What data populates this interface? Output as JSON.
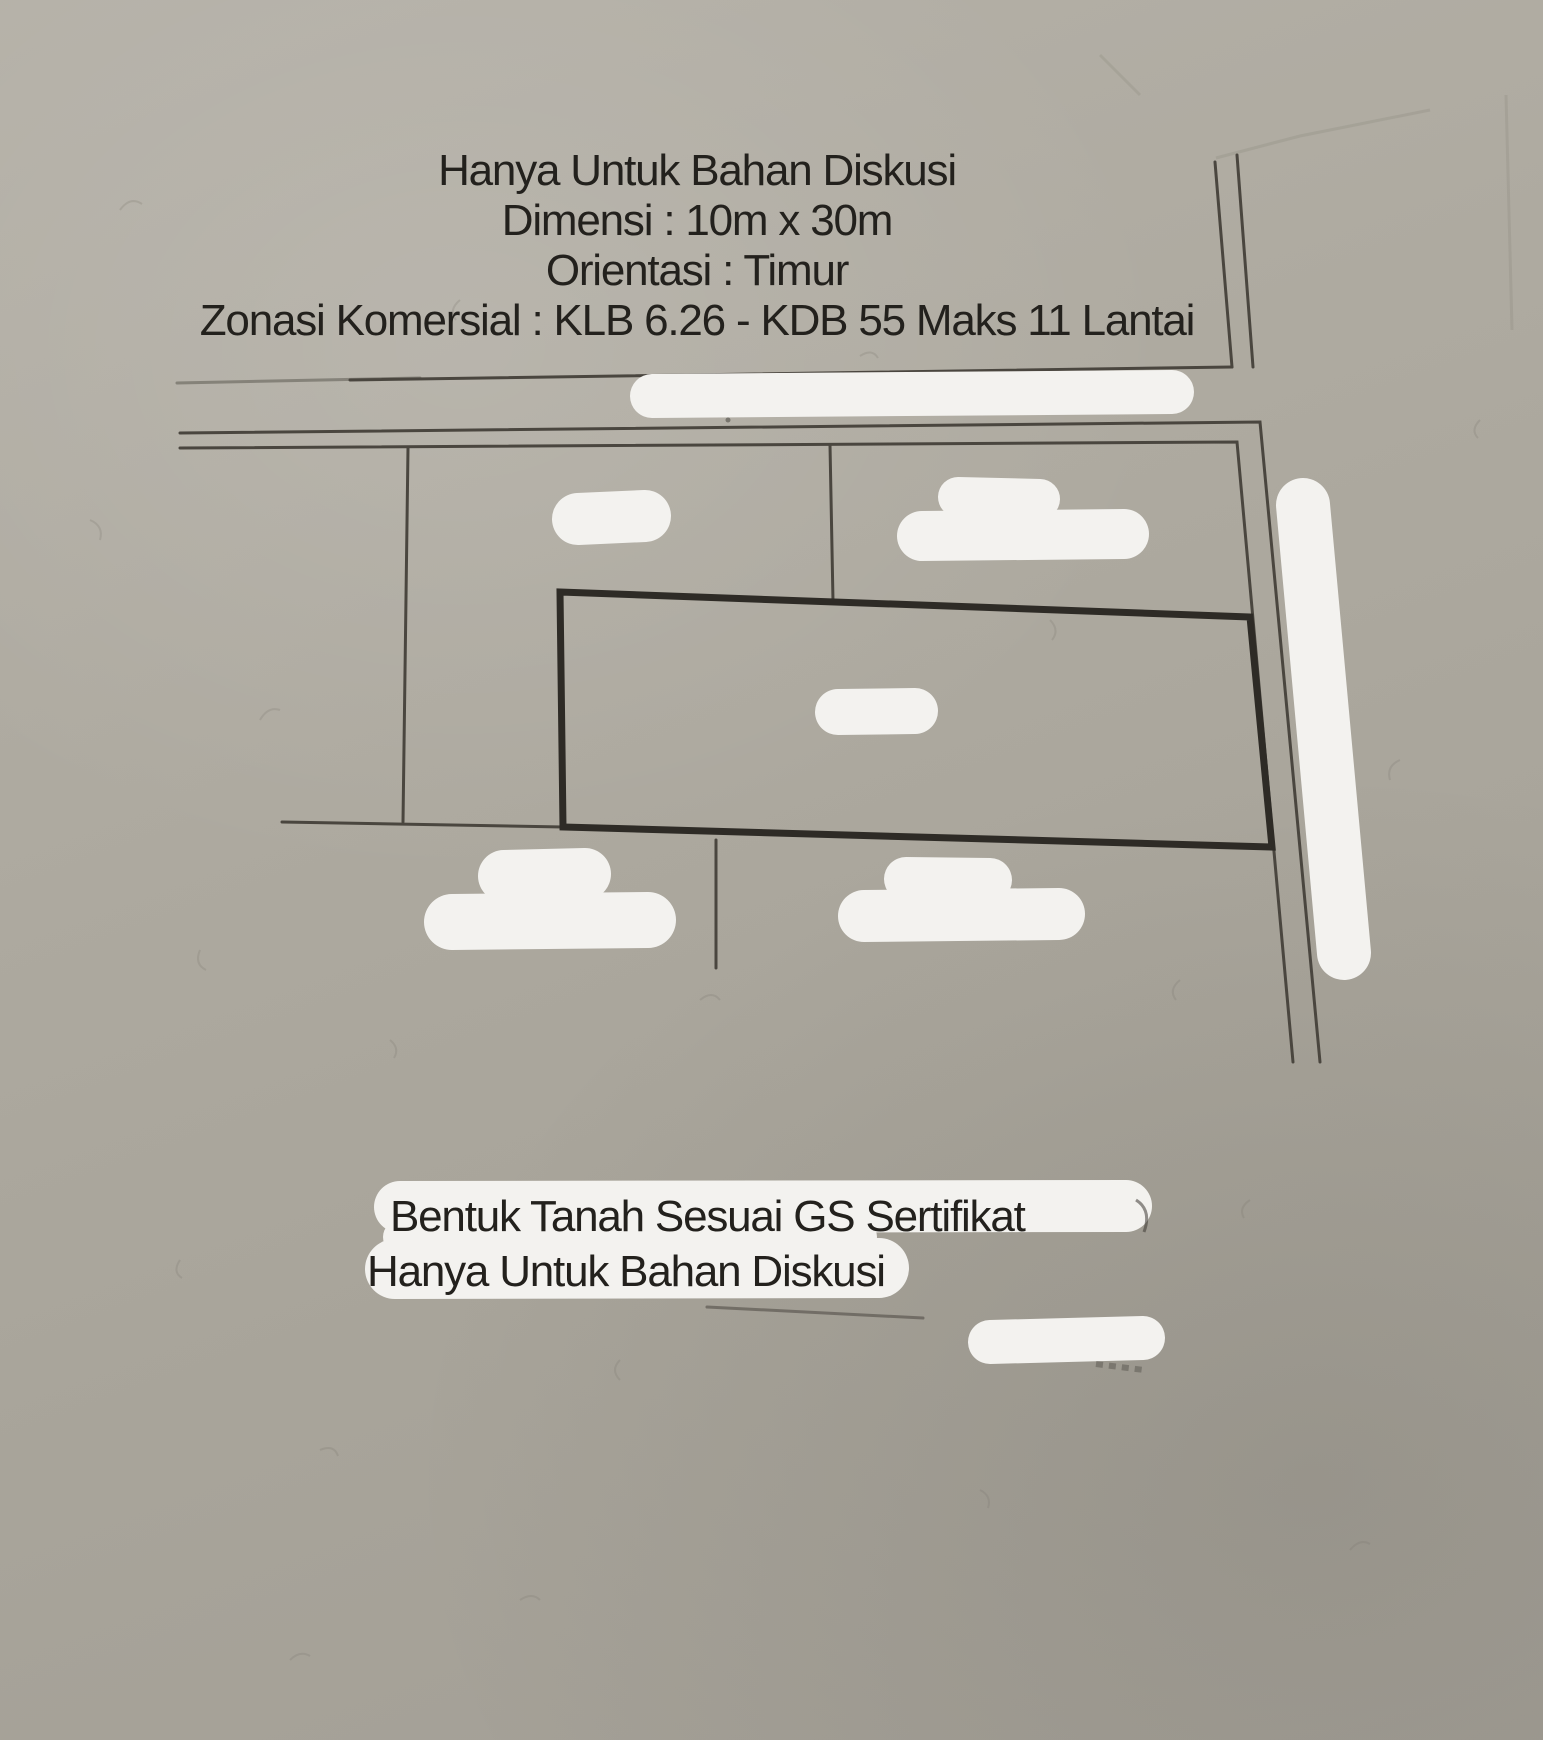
{
  "top_annotation": {
    "line1": "Hanya Untuk Bahan Diskusi",
    "line2": "Dimensi : 10m x 30m",
    "line3": "Orientasi : Timur",
    "line4": "Zonasi Komersial : KLB 6.26 - KDB 55 Maks 11 Lantai"
  },
  "bottom_annotation": {
    "line1": "Bentuk Tanah Sesuai GS Sertifikat",
    "line2": "Hanya Untuk Bahan Diskusi"
  },
  "colors": {
    "paper": "#aba79d",
    "pencil_thin": "#4a463f",
    "pencil_bold": "#2e2b26",
    "redaction_white": "#f3f2ef",
    "annotation_text": "#23211d"
  }
}
